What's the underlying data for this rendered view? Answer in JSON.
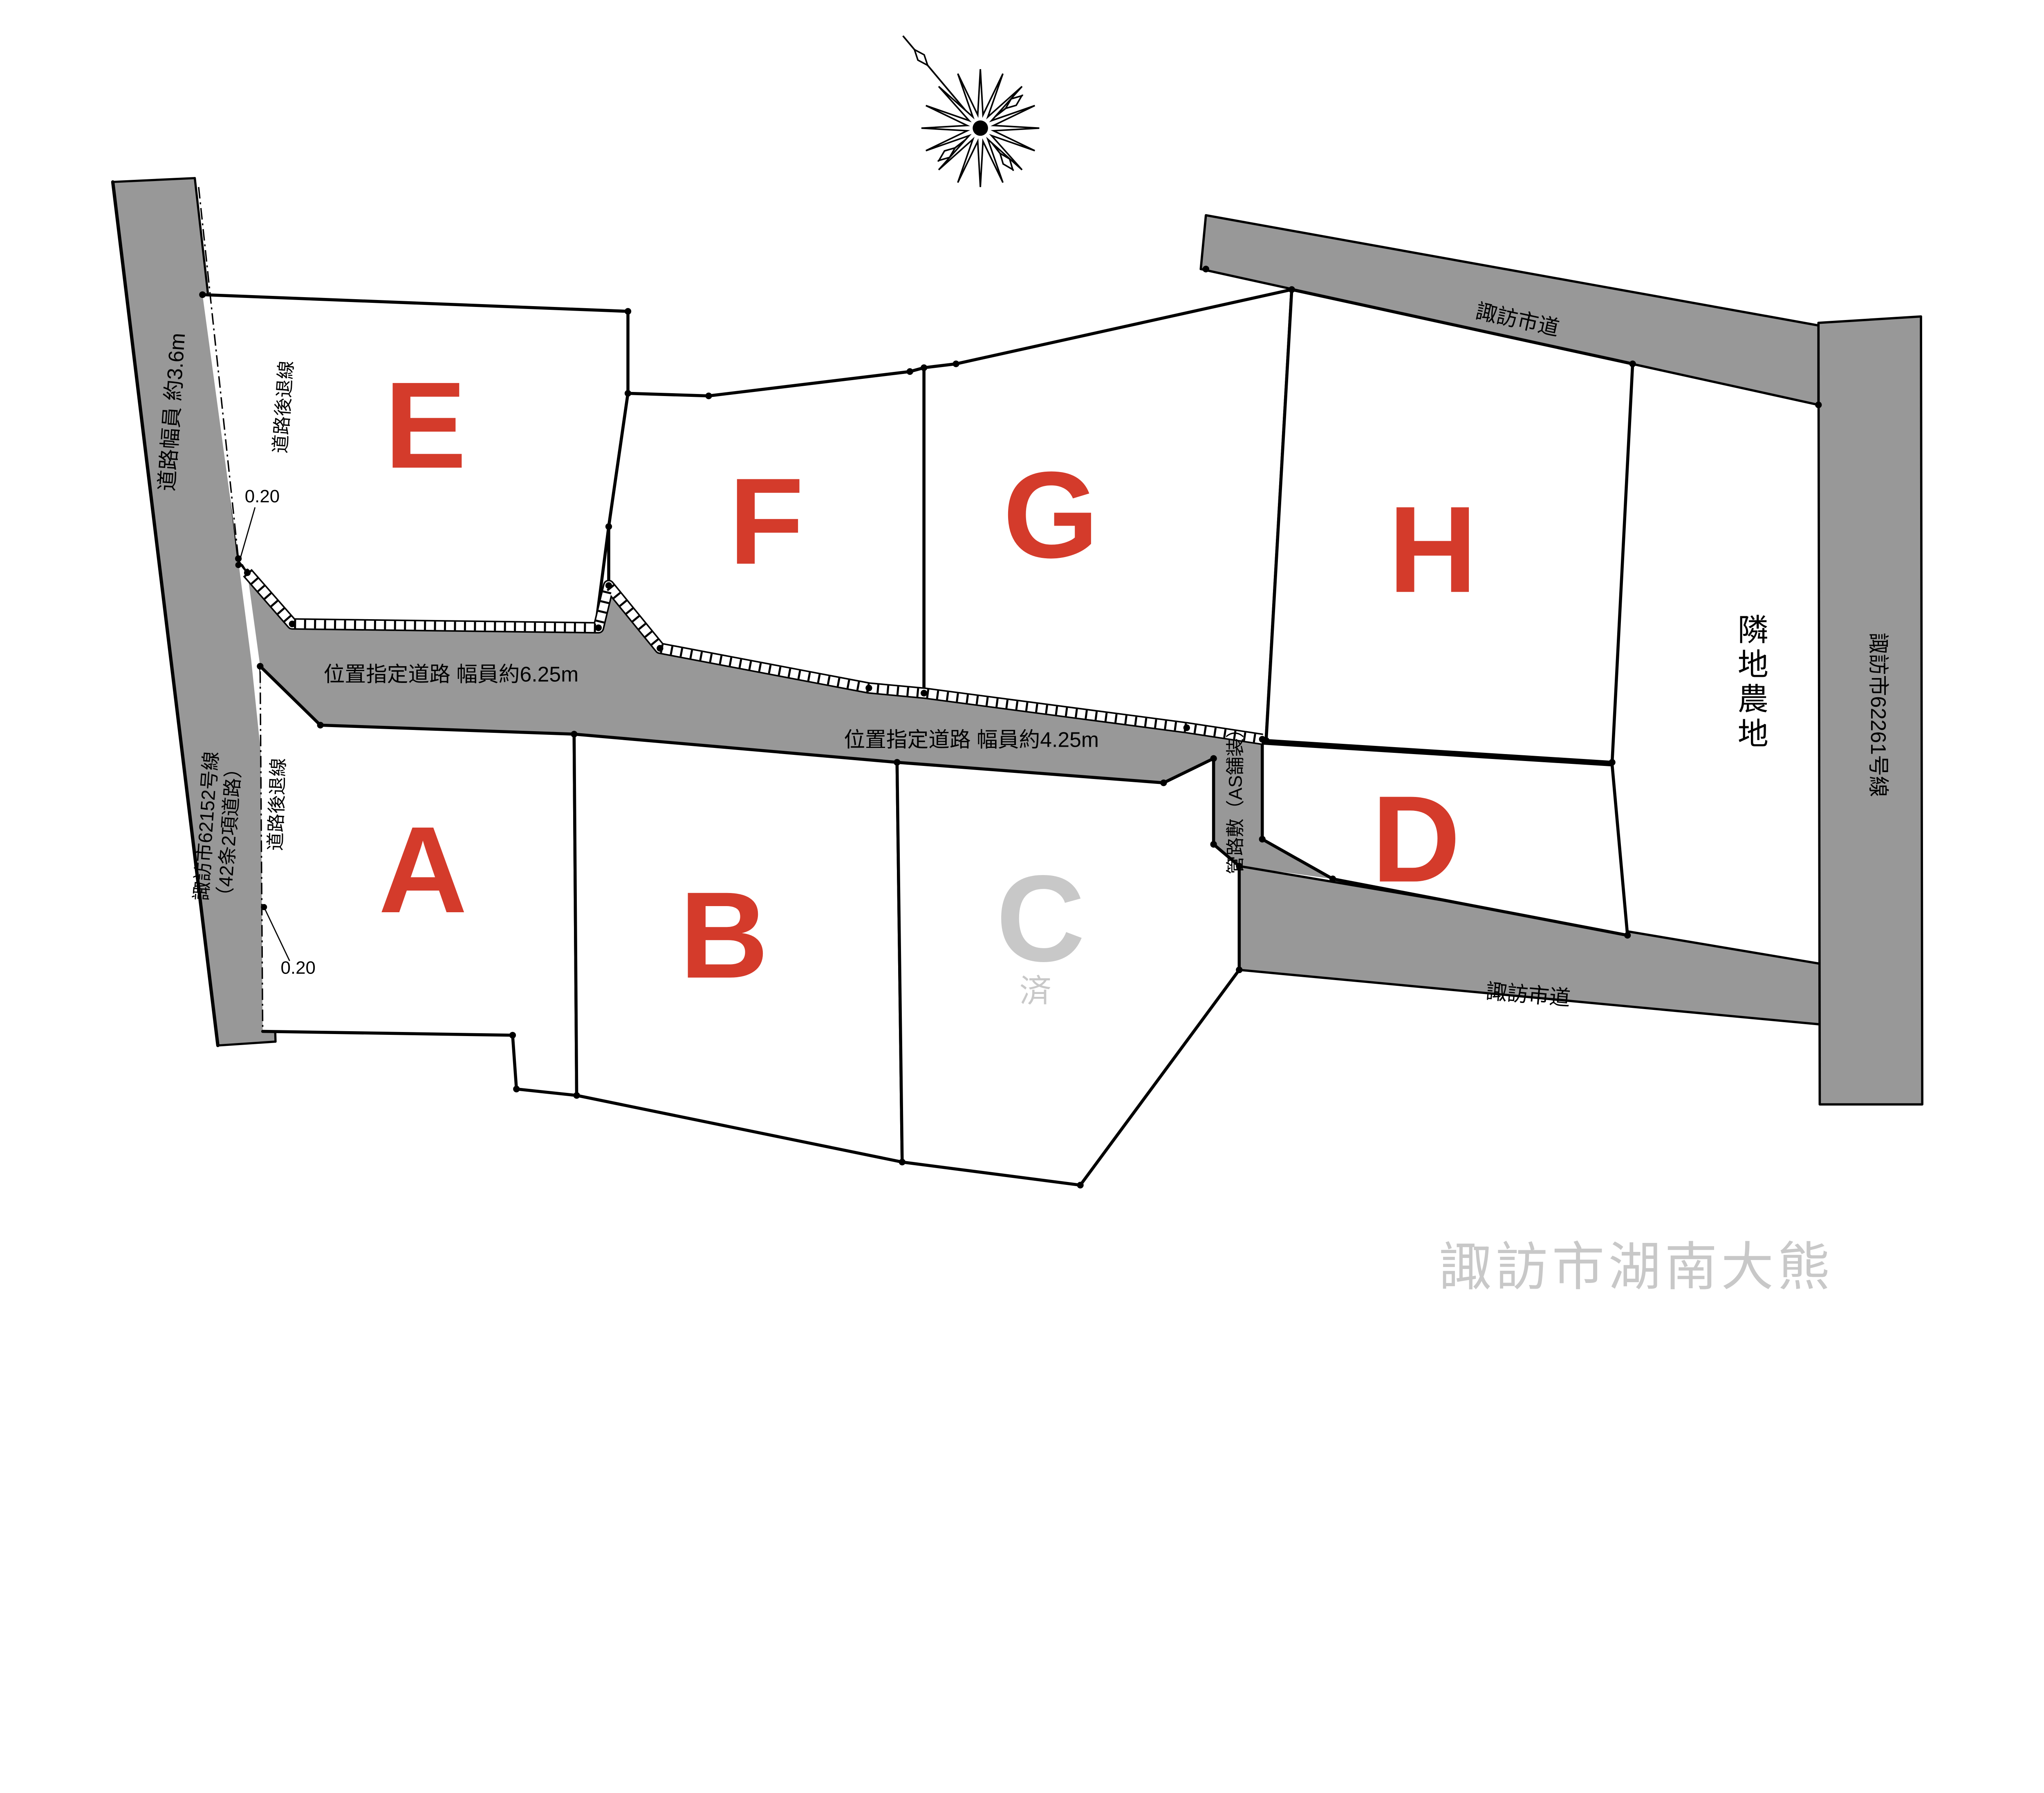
{
  "map": {
    "area_title": "諏訪市湖南大熊",
    "lots": [
      {
        "id": "A",
        "label": "A",
        "status": "available"
      },
      {
        "id": "B",
        "label": "B",
        "status": "available"
      },
      {
        "id": "C",
        "label": "C",
        "status": "sold",
        "sold_mark": "済"
      },
      {
        "id": "D",
        "label": "D",
        "status": "available"
      },
      {
        "id": "E",
        "label": "E",
        "status": "available"
      },
      {
        "id": "F",
        "label": "F",
        "status": "available"
      },
      {
        "id": "G",
        "label": "G",
        "status": "available"
      },
      {
        "id": "H",
        "label": "H",
        "status": "available"
      }
    ],
    "roads": {
      "left": {
        "name_line1": "諏訪市62152号線",
        "name_line2": "（42条2項道路）",
        "width_label": "道路幅員 約3.6m"
      },
      "designated_625": {
        "label": "位置指定道路 幅員約6.25m"
      },
      "designated_425": {
        "label": "位置指定道路 幅員約4.25m"
      },
      "pipe_strip": {
        "label": "管路敷（AS舗装）"
      },
      "city_top": {
        "label": "諏訪市道"
      },
      "city_bottom": {
        "label": "諏訪市道"
      },
      "right": {
        "label": "諏訪市62261号線"
      }
    },
    "annotations": {
      "setback_upper": "道路後退線",
      "setback_lower": "道路後退線",
      "offset_upper": "0.20",
      "offset_lower": "0.20",
      "farmland": "隣地農地",
      "farmland_chars": [
        "隣",
        "地",
        "農",
        "地"
      ]
    },
    "colors": {
      "road_fill": "#989898",
      "outline": "#000000",
      "lot_label_red": "#d43b2b",
      "sold_gray": "#c8c8c8",
      "area_title_gray": "#c8c8c8"
    }
  }
}
